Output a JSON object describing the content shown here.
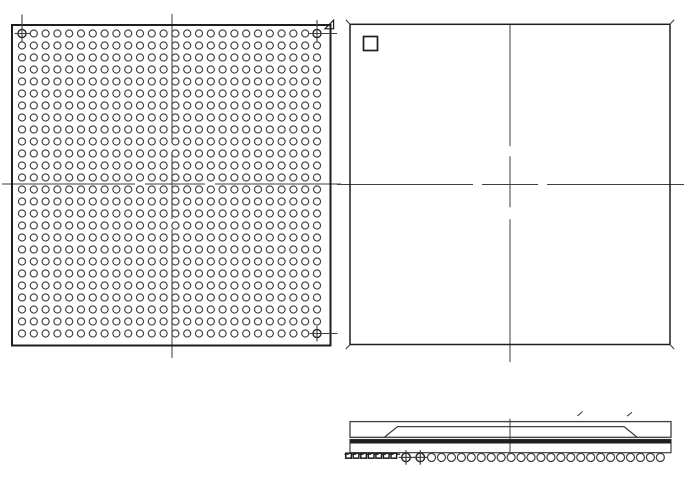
{
  "drawing_title": "BGA package outline drawing: bottom view ball grid, top view, side view",
  "colors": {
    "line": "#3f3f3f",
    "line_dark": "#1e1e1e",
    "background": "#ffffff"
  },
  "bottom_view": {
    "outline": {
      "x": 12,
      "y": 25,
      "width": 318.5,
      "height": 320.5,
      "stroke_width": 2
    },
    "grid": {
      "rows": 26,
      "cols": 26,
      "total_balls": 676,
      "start_x": 22,
      "start_y": 33.5,
      "pitch_x": 11.8,
      "pitch_y": 12.0,
      "ball_radius": 3.55,
      "ball_stroke": 1.15
    },
    "fiducial_balls": [
      {
        "col": 0,
        "row": 0,
        "v_line": [
          14.5,
          42
        ],
        "h_line": [
          14.5,
          30
        ]
      },
      {
        "col": 25,
        "row": 0,
        "v_line": [
          20,
          42
        ],
        "h_line": [
          309.5,
          337
        ]
      },
      {
        "col": 25,
        "row": 25,
        "v_line": [
          326,
          341.5
        ],
        "h_line": [
          309.5,
          337.5
        ]
      }
    ],
    "pin1_flag": {
      "points": "325,28.8 333.6,20.2 333.6,28.8"
    },
    "centerlines": {
      "vertical": {
        "x": 172,
        "y1": 14,
        "y2": 358,
        "dash": "129 10 66 10 129"
      },
      "horizontal": {
        "y": 184,
        "x1": 2,
        "x2": 341,
        "dash": "133 10 60 10 126"
      }
    }
  },
  "top_view": {
    "outline": {
      "x": 350,
      "y": 24.3,
      "width": 320,
      "height": 320.2,
      "stroke_width": 1.5
    },
    "pin1_marker": {
      "x": 363.5,
      "y": 36.5,
      "size": 14,
      "stroke_width": 1.7
    },
    "corner_marks": [
      {
        "x1": 345.8,
        "y1": 19.8,
        "x2": 350.4,
        "y2": 24.5
      },
      {
        "x1": 674.2,
        "y1": 19.8,
        "x2": 669.6,
        "y2": 24.5
      },
      {
        "x1": 345.8,
        "y1": 349.0,
        "x2": 350.4,
        "y2": 344.3
      },
      {
        "x1": 674.2,
        "y1": 349.0,
        "x2": 669.6,
        "y2": 344.3
      }
    ],
    "centerlines": {
      "vertical": {
        "x": 510,
        "y1": 24.3,
        "y2": 362,
        "dash": "122 10 51 12 143"
      },
      "horizontal": {
        "y": 184.5,
        "x1": 337,
        "x2": 684,
        "dash": "136 9 56 9 137"
      }
    }
  },
  "side_view": {
    "body": {
      "x": 350,
      "y": 421.6,
      "width": 321,
      "height": 15.7,
      "stroke_width": 1.3
    },
    "lid_path": "M384.5,437.1 L397.5,426.6 L624,426.6 L637,437.1",
    "substrate": {
      "x": 350,
      "y": 439.5,
      "width": 321,
      "height": 13.2,
      "stroke_width": 1.2,
      "top_bar_height": 4
    },
    "centerline": {
      "x": 510,
      "y1": 418.8,
      "y2": 453.5
    },
    "ticks": [
      {
        "x1": 577.5,
        "y1": 416.0,
        "x2": 582.5,
        "y2": 411.5
      },
      {
        "x1": 627.0,
        "y1": 416.2,
        "x2": 632.0,
        "y2": 412.3
      }
    ],
    "balls": {
      "cy": 457.4,
      "radius": 4.05,
      "stroke": 1.2,
      "open": {
        "count": 24,
        "start_x": 431.5,
        "pitch": 9.95
      },
      "crosshair": {
        "xs": [
          406,
          420.3
        ],
        "radius": 4.3,
        "cross_extend": 3
      },
      "collapsed_marks": {
        "count": 7,
        "start_x": 348.5,
        "pitch": 7.55,
        "width": 5.6,
        "height": 5,
        "top_y": 453.2
      },
      "dash_line": {
        "y": 454.3,
        "x1": 344.5,
        "x2": 400,
        "dash": "4.2 3.3"
      }
    }
  }
}
